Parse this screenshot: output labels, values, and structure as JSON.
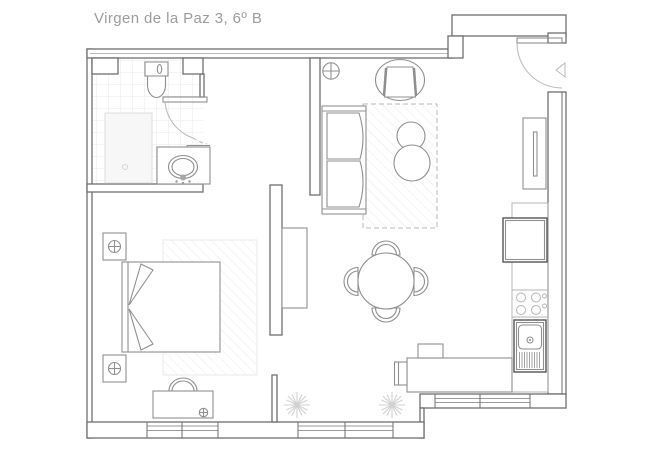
{
  "title": "Virgen de la Paz 3, 6º B",
  "colors": {
    "background": "#ffffff",
    "wall": "#6f6f6f",
    "furniture": "#8f8f8f",
    "light_line": "#b9b9b9",
    "counter": "#b5b5b5",
    "tile": "#e9e9e9",
    "hatch": "#ededed",
    "title_text": "#9c9c9c"
  },
  "floor_plan": {
    "type": "apartment-floor-plan",
    "rooms": [
      {
        "name": "bathroom",
        "fixtures": [
          "toilet",
          "shower-tray",
          "sink-vanity",
          "door-swing",
          "tiled-floor"
        ]
      },
      {
        "name": "bedroom",
        "fixtures": [
          "double-bed",
          "pillows",
          "nightstand-top",
          "nightstand-bottom",
          "table-lamp-top",
          "table-lamp-bottom",
          "bench-with-bag",
          "rug",
          "window"
        ]
      },
      {
        "name": "living-room",
        "fixtures": [
          "sofa",
          "armchair",
          "round-side-table-small",
          "round-side-table-large",
          "rug",
          "ceiling-light",
          "wardrobe-cabinet",
          "tv-cabinet",
          "window"
        ]
      },
      {
        "name": "dining-area",
        "fixtures": [
          "round-table",
          "chair-north",
          "chair-south",
          "chair-east",
          "chair-west",
          "desk",
          "desk-chair",
          "plants"
        ]
      },
      {
        "name": "kitchen",
        "fixtures": [
          "fridge",
          "hob-4-burners",
          "sink-with-drainer",
          "counter",
          "window"
        ]
      },
      {
        "name": "entry",
        "fixtures": [
          "entry-door-swing"
        ]
      }
    ],
    "window_count": 3,
    "plant_count": 2
  }
}
